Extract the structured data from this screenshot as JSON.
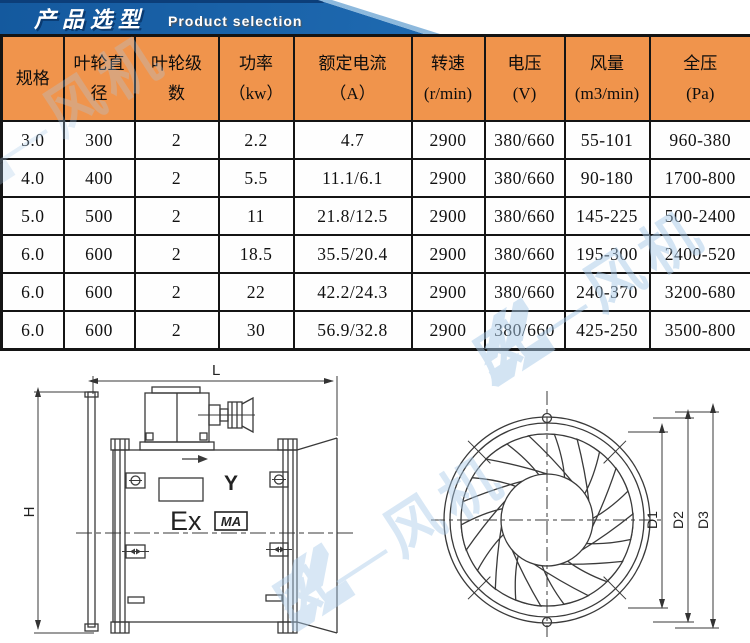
{
  "banner": {
    "title_cn": "产品选型",
    "title_en": "Product selection"
  },
  "table": {
    "headers": [
      "规格",
      "叶轮直\n径",
      "叶轮级\n数",
      "功率\n（kw）",
      "额定电流\n（A）",
      "转速\n(r/min)",
      "电压\n(V)",
      "风量\n(m3/min)",
      "全压\n(Pa)"
    ],
    "rows": [
      [
        "3.0",
        "300",
        "2",
        "2.2",
        "4.7",
        "2900",
        "380/660",
        "55-101",
        "960-380"
      ],
      [
        "4.0",
        "400",
        "2",
        "5.5",
        "11.1/6.1",
        "2900",
        "380/660",
        "90-180",
        "1700-800"
      ],
      [
        "5.0",
        "500",
        "2",
        "11",
        "21.8/12.5",
        "2900",
        "380/660",
        "145-225",
        "500-2400"
      ],
      [
        "6.0",
        "600",
        "2",
        "18.5",
        "35.5/20.4",
        "2900",
        "380/660",
        "195-300",
        "2400-520"
      ],
      [
        "6.0",
        "600",
        "2",
        "22",
        "42.2/24.3",
        "2900",
        "380/660",
        "240-370",
        "3200-680"
      ],
      [
        "6.0",
        "600",
        "2",
        "30",
        "56.9/32.8",
        "2900",
        "380/660",
        "425-250",
        "3500-800"
      ]
    ]
  },
  "drawings": {
    "side_view": {
      "length_label": "L",
      "height_label": "H",
      "ex_marking": "Ex",
      "ma_marking": "MA",
      "winding_symbol": "Y"
    },
    "front_view": {
      "d1_label": "D1",
      "d2_label": "D2",
      "d3_label": "D3"
    }
  },
  "watermark": {
    "text": "风—风机"
  },
  "colors": {
    "banner_blue": "#1b65ae",
    "header_orange": "#f0944c",
    "border_black": "#141414",
    "drawing_stroke": "#3a3a3a",
    "watermark_blue": "#a9cbe9"
  }
}
